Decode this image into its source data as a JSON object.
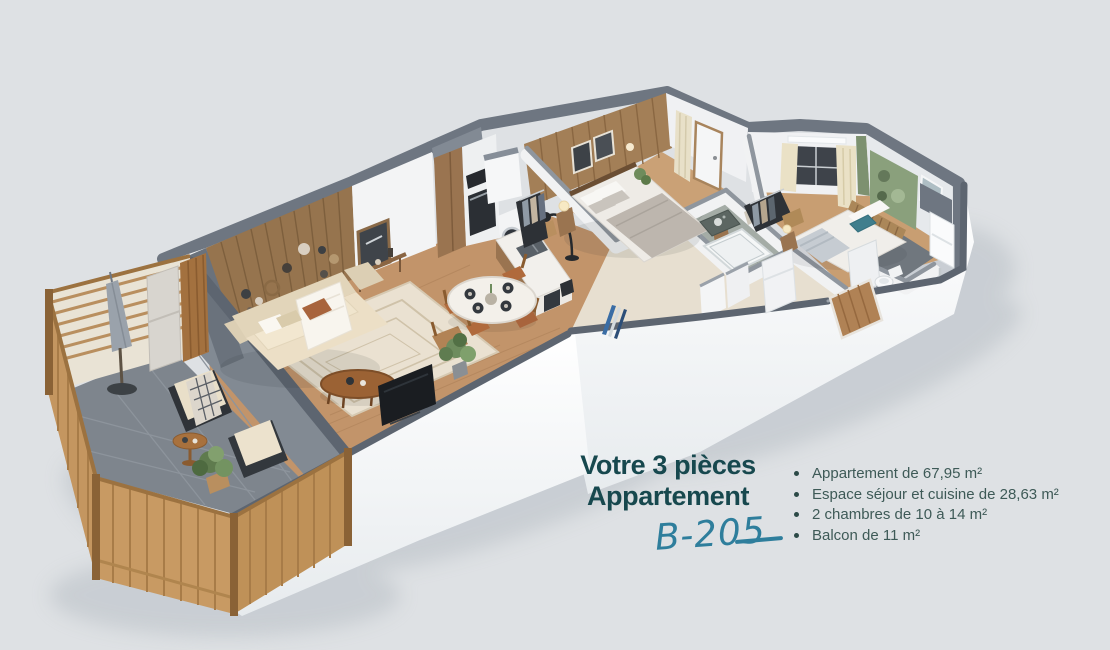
{
  "background_color": "#dee1e4",
  "caption": {
    "title_line1": "Votre 3 pièces",
    "title_line2": "Appartement",
    "unit_code": "B-205"
  },
  "details": [
    "Appartement de 67,95 m²",
    "Espace séjour et cuisine de 28,63 m²",
    "2 chambres de 10 à 14 m²",
    "Balcon de 11 m²"
  ],
  "colors": {
    "title_text": "#17484e",
    "unit_code_text": "#2e7e9c",
    "details_text": "#3e5a57",
    "wall_top_dark": "#6b7380",
    "wall_white": "#f1f2f3",
    "wood_floor": "#c2946a",
    "accent_wood_wall": "#96744e",
    "balcony_wood": "#c49660",
    "balcony_floor": "#7e858d",
    "teal_pillow": "#3f7e8d"
  },
  "floorplan_alt": "3D isometric floor plan of a 3-room apartment: balcony, living room, open kitchen, two bedrooms, bathroom and WC"
}
